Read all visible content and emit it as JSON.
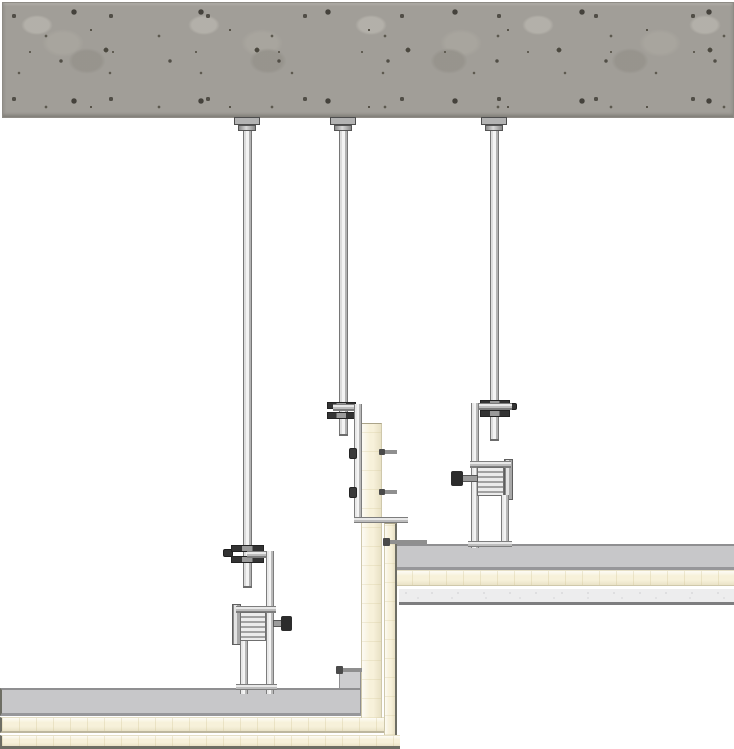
{
  "meta": {
    "description": "Technical section drawing: two-level suspended plasterboard ceiling (bulkhead / change-of-level detail) hung from a concrete soffit with threaded rods and nonius hangers",
    "visible_text": "none"
  },
  "palette": {
    "background": "#ffffff",
    "concrete_base": "#a19e98",
    "concrete_speckle_dark": "#514e47",
    "channel_gray": "#c7c7c9",
    "channel_edge": "#8f8f91",
    "board_cream": "#f7f1da",
    "board_cream_edge": "#cfc8ab",
    "board_light": "#ededee",
    "board_light_edge": "#7d7d7f",
    "clip_dark": "#333333",
    "bolt_dark": "#2c2c2c",
    "metal_light": "#ededed",
    "metal_dark": "#7d7d7d"
  },
  "components": {
    "structure": {
      "concrete_soffit": "reinforced concrete slab, speckled texture, full width at top"
    },
    "suspension": {
      "hanger_rod_count": 3,
      "rod_anchor_count": 3,
      "nonius_clip_count": 3,
      "nonius_hanger_bracket_count": 2,
      "locking_bolt_count": 2,
      "hanger_strap_count": 3
    },
    "upper_ceiling": {
      "layers": [
        "furring channel (grey)",
        "plasterboard (cream)",
        "finishing board (light grey)"
      ]
    },
    "lower_ceiling": {
      "layers": [
        "furring channel (grey)",
        "plasterboard layer 1 (cream)",
        "plasterboard layer 2 (cream)"
      ]
    },
    "bulkhead": {
      "layers": [
        "inner vertical board (cream)",
        "outer vertical board (cream)"
      ],
      "fixings": "screws at both faces"
    }
  }
}
